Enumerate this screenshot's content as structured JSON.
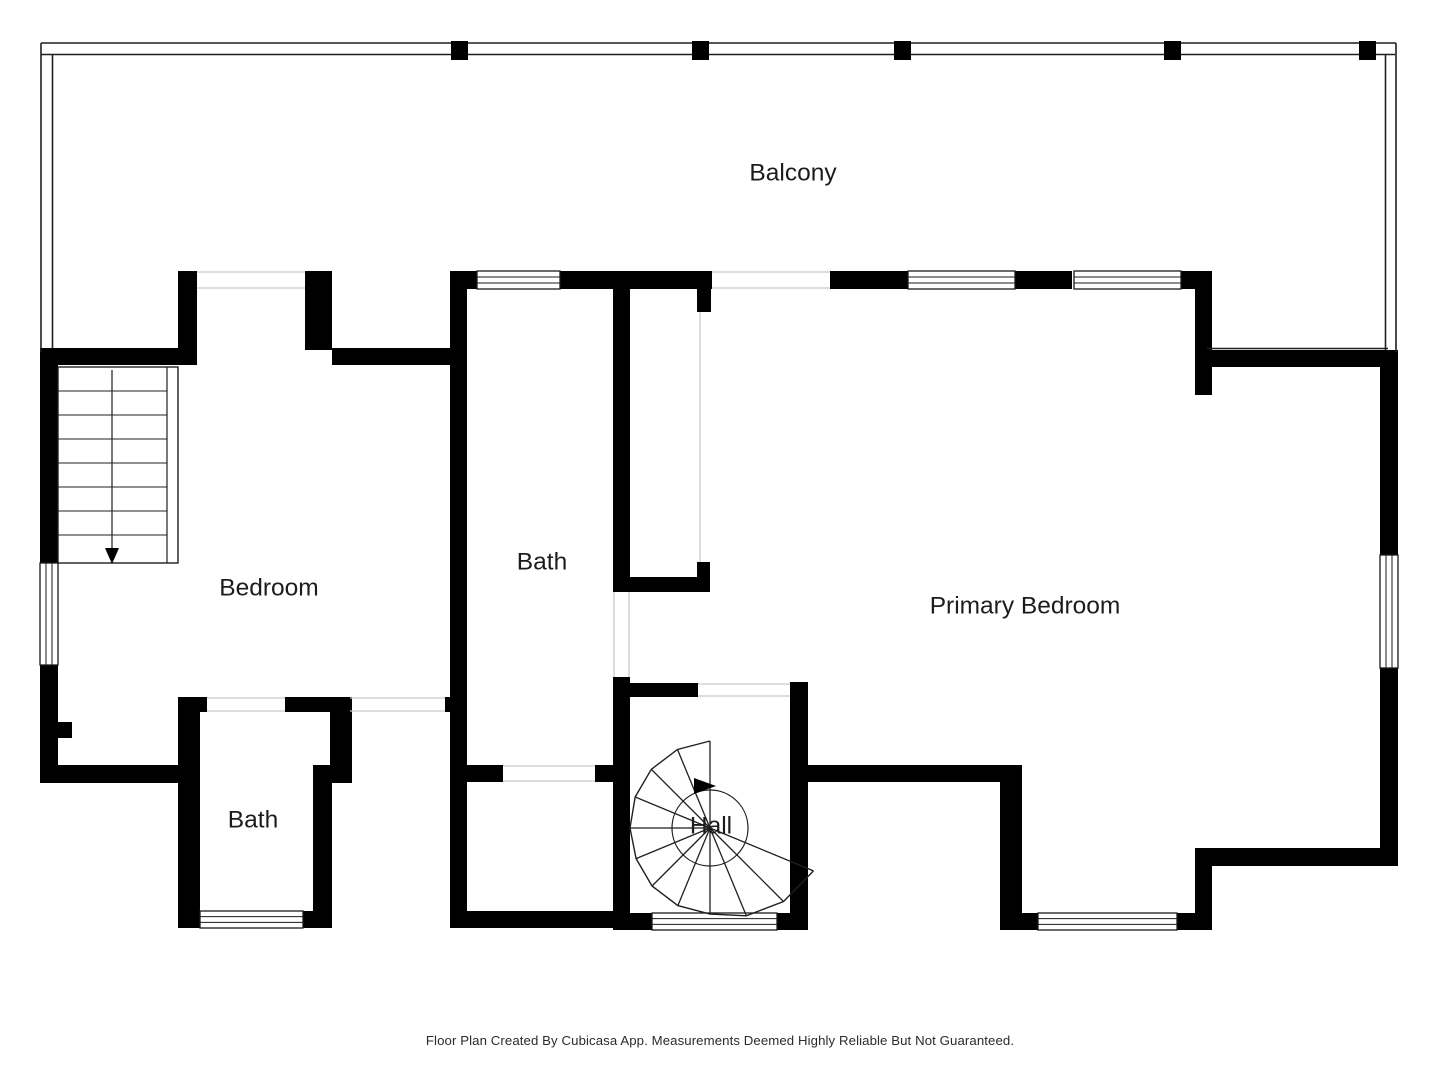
{
  "page": {
    "footer": "Floor Plan Created By Cubicasa App. Measurements Deemed Highly Reliable But Not Guaranteed.",
    "colors": {
      "background": "#ffffff",
      "wall": "#000000",
      "thin_line": "#1f1f1f",
      "door_line": "#c9c9c9",
      "window_line": "#1a1a1a",
      "label": "#1c1c1c",
      "footer": "#2b2b2b"
    }
  },
  "rooms": [
    {
      "id": "balcony",
      "label": "Balcony",
      "x": 793,
      "y": 172
    },
    {
      "id": "bedroom",
      "label": "Bedroom",
      "x": 269,
      "y": 587
    },
    {
      "id": "bath-middle",
      "label": "Bath",
      "x": 542,
      "y": 561
    },
    {
      "id": "primary-bedroom",
      "label": "Primary Bedroom",
      "x": 1025,
      "y": 605
    },
    {
      "id": "bath-lower",
      "label": "Bath",
      "x": 253,
      "y": 819
    },
    {
      "id": "hall",
      "label": "Hall",
      "x": 711,
      "y": 825
    }
  ],
  "plan": {
    "label_font_size": 24.5,
    "walls": [
      [
        450,
        271,
        27,
        18
      ],
      [
        560,
        271,
        152,
        18
      ],
      [
        830,
        271,
        78,
        18
      ],
      [
        1015,
        271,
        57,
        18
      ],
      [
        1180,
        271,
        32,
        18
      ],
      [
        178,
        271,
        19,
        94
      ],
      [
        305,
        271,
        27,
        79
      ],
      [
        40,
        348,
        138,
        17
      ],
      [
        332,
        348,
        135,
        17
      ],
      [
        40,
        348,
        18,
        215
      ],
      [
        40,
        665,
        18,
        118
      ],
      [
        40,
        765,
        160,
        18
      ],
      [
        58,
        722,
        14,
        16
      ],
      [
        178,
        698,
        22,
        230
      ],
      [
        178,
        697,
        29,
        15
      ],
      [
        285,
        697,
        65,
        15
      ],
      [
        330,
        697,
        22,
        70
      ],
      [
        313,
        765,
        39,
        18
      ],
      [
        313,
        783,
        19,
        145
      ],
      [
        178,
        911,
        154,
        17
      ],
      [
        445,
        697,
        22,
        15
      ],
      [
        450,
        271,
        17,
        657
      ],
      [
        450,
        911,
        180,
        17
      ],
      [
        613,
        289,
        17,
        303
      ],
      [
        613,
        577,
        97,
        15
      ],
      [
        697,
        289,
        14,
        23
      ],
      [
        697,
        562,
        13,
        15
      ],
      [
        613,
        683,
        85,
        14
      ],
      [
        613,
        677,
        17,
        253
      ],
      [
        450,
        765,
        53,
        17
      ],
      [
        595,
        765,
        35,
        17
      ],
      [
        790,
        682,
        18,
        248
      ],
      [
        630,
        913,
        22,
        17
      ],
      [
        777,
        913,
        31,
        17
      ],
      [
        808,
        765,
        214,
        17
      ],
      [
        1000,
        765,
        22,
        165
      ],
      [
        1000,
        913,
        212,
        17
      ],
      [
        1195,
        848,
        17,
        82
      ],
      [
        1207,
        848,
        191,
        18
      ],
      [
        1380,
        350,
        18,
        205
      ],
      [
        1380,
        668,
        18,
        182
      ],
      [
        1207,
        350,
        191,
        17
      ],
      [
        1195,
        289,
        17,
        106
      ]
    ],
    "windows": [
      {
        "x": 477,
        "y": 271,
        "w": 83,
        "h": 18,
        "o": "h"
      },
      {
        "x": 908,
        "y": 271,
        "w": 107,
        "h": 18,
        "o": "h"
      },
      {
        "x": 1074,
        "y": 271,
        "w": 107,
        "h": 18,
        "o": "h"
      },
      {
        "x": 40,
        "y": 563,
        "w": 18,
        "h": 102,
        "o": "v"
      },
      {
        "x": 200,
        "y": 911,
        "w": 103,
        "h": 17,
        "o": "h"
      },
      {
        "x": 652,
        "y": 913,
        "w": 125,
        "h": 17,
        "o": "h"
      },
      {
        "x": 1038,
        "y": 913,
        "w": 139,
        "h": 17,
        "o": "h"
      },
      {
        "x": 1380,
        "y": 555,
        "w": 18,
        "h": 113,
        "o": "v"
      }
    ],
    "door_lines": [
      [
        197,
        272,
        305,
        272
      ],
      [
        197,
        288,
        305,
        288
      ],
      [
        712,
        272,
        830,
        272
      ],
      [
        712,
        288,
        830,
        288
      ],
      [
        207,
        698,
        285,
        698
      ],
      [
        207,
        711,
        285,
        711
      ],
      [
        350,
        698,
        445,
        698
      ],
      [
        350,
        711,
        445,
        711
      ],
      [
        503,
        766,
        595,
        766
      ],
      [
        503,
        781,
        595,
        781
      ],
      [
        614,
        592,
        614,
        677
      ],
      [
        629,
        592,
        629,
        677
      ],
      [
        698,
        684,
        790,
        684
      ],
      [
        698,
        696,
        790,
        696
      ],
      [
        700,
        312,
        700,
        562
      ]
    ],
    "rail_lines": [
      [
        41,
        43,
        1396,
        43
      ],
      [
        41,
        54.5,
        1395,
        54.5
      ],
      [
        41,
        43,
        41,
        352
      ],
      [
        52.5,
        54.5,
        52.5,
        348
      ],
      [
        1396,
        43,
        1396,
        352
      ],
      [
        1385.5,
        54.5,
        1385.5,
        350
      ],
      [
        1207,
        348.5,
        1388,
        348.5
      ]
    ],
    "posts": [
      [
        451,
        41,
        17,
        19
      ],
      [
        692,
        41,
        17,
        19
      ],
      [
        894,
        41,
        17,
        19
      ],
      [
        1164,
        41,
        17,
        19
      ],
      [
        1359,
        41,
        17,
        19
      ]
    ],
    "straight_stairs": {
      "box": [
        58,
        367,
        120,
        196
      ],
      "inner_x": 167,
      "treads": [
        391,
        415,
        439,
        463,
        487,
        511,
        535
      ],
      "walk": {
        "x": 112,
        "y1": 370,
        "y2": 548
      },
      "arrow": [
        [
          105,
          548
        ],
        [
          119,
          548
        ],
        [
          112,
          564
        ]
      ]
    },
    "spiral_stairs": {
      "cx": 710,
      "cy": 828,
      "start_angle": 270,
      "step_angle": 22.5,
      "radii": [
        87,
        85,
        83,
        81,
        80,
        80,
        82,
        84,
        86,
        95,
        104,
        112
      ],
      "inner_radius": 38,
      "arrow": [
        [
          694,
          778
        ],
        [
          716,
          786
        ],
        [
          694,
          794
        ]
      ]
    }
  }
}
